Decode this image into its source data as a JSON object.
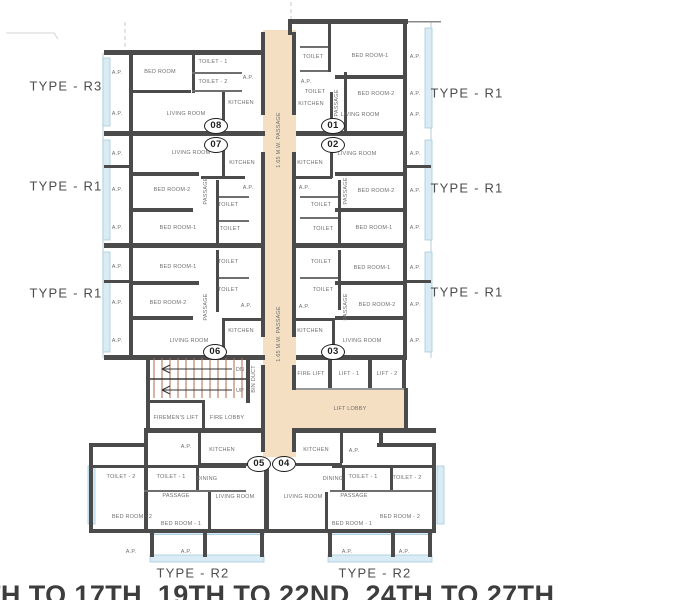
{
  "plan": {
    "caption": "TH TO 17TH, 19TH TO 22ND, 24TH TO 27TH",
    "colors": {
      "wall": "#4b4b4b",
      "corridor": "#f4dfc2",
      "window": "#d9ecf5",
      "stair_tread": "#b06a52"
    },
    "type_labels": [
      {
        "text": "TYPE - R3",
        "x": 66,
        "y": 86
      },
      {
        "text": "TYPE - R1",
        "x": 66,
        "y": 186
      },
      {
        "text": "TYPE - R1",
        "x": 66,
        "y": 293
      },
      {
        "text": "TYPE - R1",
        "x": 467,
        "y": 93
      },
      {
        "text": "TYPE - R1",
        "x": 467,
        "y": 188
      },
      {
        "text": "TYPE - R1",
        "x": 467,
        "y": 292
      },
      {
        "text": "TYPE - R2",
        "x": 193,
        "y": 573
      },
      {
        "text": "TYPE - R2",
        "x": 375,
        "y": 573
      }
    ],
    "unit_circles": [
      {
        "num": "08",
        "x": 216,
        "y": 126
      },
      {
        "num": "07",
        "x": 216,
        "y": 145
      },
      {
        "num": "01",
        "x": 333,
        "y": 126
      },
      {
        "num": "02",
        "x": 333,
        "y": 145
      },
      {
        "num": "06",
        "x": 215,
        "y": 352
      },
      {
        "num": "03",
        "x": 333,
        "y": 352
      },
      {
        "num": "05",
        "x": 259,
        "y": 464
      },
      {
        "num": "04",
        "x": 284,
        "y": 464
      }
    ],
    "room_labels": [
      {
        "text": "A.P.",
        "x": 117,
        "y": 73
      },
      {
        "text": "BED ROOM",
        "x": 160,
        "y": 72
      },
      {
        "text": "TOILET - 1",
        "x": 213,
        "y": 62
      },
      {
        "text": "TOILET - 2",
        "x": 213,
        "y": 82
      },
      {
        "text": "A.P.",
        "x": 248,
        "y": 78
      },
      {
        "text": "KITCHEN",
        "x": 241,
        "y": 103
      },
      {
        "text": "A.P.",
        "x": 117,
        "y": 114
      },
      {
        "text": "LIVING ROOM",
        "x": 186,
        "y": 114
      },
      {
        "text": "TOILET",
        "x": 313,
        "y": 57
      },
      {
        "text": "BED ROOM-1",
        "x": 370,
        "y": 56
      },
      {
        "text": "A.P.",
        "x": 415,
        "y": 57
      },
      {
        "text": "TOILET",
        "x": 315,
        "y": 92
      },
      {
        "text": "PASSAGE",
        "x": 337,
        "y": 103,
        "rot": -90
      },
      {
        "text": "BED ROOM-2",
        "x": 376,
        "y": 94
      },
      {
        "text": "A.P.",
        "x": 415,
        "y": 94
      },
      {
        "text": "A.P.",
        "x": 306,
        "y": 82
      },
      {
        "text": "KITCHEN",
        "x": 311,
        "y": 104
      },
      {
        "text": "LIVING ROOM",
        "x": 360,
        "y": 115
      },
      {
        "text": "A.P.",
        "x": 415,
        "y": 115
      },
      {
        "text": "KITCHEN",
        "x": 310,
        "y": 163
      },
      {
        "text": "LIVING ROOM",
        "x": 357,
        "y": 154
      },
      {
        "text": "A.P.",
        "x": 415,
        "y": 154
      },
      {
        "text": "A.P.",
        "x": 304,
        "y": 188
      },
      {
        "text": "BED ROOM-2",
        "x": 376,
        "y": 191
      },
      {
        "text": "A.P.",
        "x": 415,
        "y": 191
      },
      {
        "text": "PASSAGE",
        "x": 346,
        "y": 191,
        "rot": -90
      },
      {
        "text": "TOILET",
        "x": 321,
        "y": 205
      },
      {
        "text": "TOILET",
        "x": 323,
        "y": 229
      },
      {
        "text": "BED ROOM-1",
        "x": 374,
        "y": 228
      },
      {
        "text": "A.P.",
        "x": 415,
        "y": 228
      },
      {
        "text": "TOILET",
        "x": 321,
        "y": 262
      },
      {
        "text": "BED ROOM-1",
        "x": 372,
        "y": 268
      },
      {
        "text": "A.P.",
        "x": 415,
        "y": 268
      },
      {
        "text": "TOILET",
        "x": 323,
        "y": 290
      },
      {
        "text": "BED ROOM-2",
        "x": 377,
        "y": 305
      },
      {
        "text": "A.P.",
        "x": 415,
        "y": 305
      },
      {
        "text": "PASSAGE",
        "x": 346,
        "y": 307,
        "rot": -90
      },
      {
        "text": "A.P.",
        "x": 304,
        "y": 307
      },
      {
        "text": "KITCHEN",
        "x": 310,
        "y": 331
      },
      {
        "text": "LIVING ROOM",
        "x": 362,
        "y": 341
      },
      {
        "text": "A.P.",
        "x": 415,
        "y": 341
      },
      {
        "text": "A.P.",
        "x": 117,
        "y": 154
      },
      {
        "text": "LIVING ROOM",
        "x": 191,
        "y": 153
      },
      {
        "text": "KITCHEN",
        "x": 242,
        "y": 163
      },
      {
        "text": "A.P.",
        "x": 117,
        "y": 190
      },
      {
        "text": "BED ROOM-2",
        "x": 172,
        "y": 190
      },
      {
        "text": "PASSAGE",
        "x": 206,
        "y": 191,
        "rot": -90
      },
      {
        "text": "A.P.",
        "x": 248,
        "y": 188
      },
      {
        "text": "TOILET",
        "x": 228,
        "y": 205
      },
      {
        "text": "TOILET",
        "x": 230,
        "y": 229
      },
      {
        "text": "A.P.",
        "x": 117,
        "y": 228
      },
      {
        "text": "BED ROOM-1",
        "x": 178,
        "y": 228
      },
      {
        "text": "A.P.",
        "x": 117,
        "y": 267
      },
      {
        "text": "BED ROOM-1",
        "x": 178,
        "y": 267
      },
      {
        "text": "TOILET",
        "x": 228,
        "y": 262
      },
      {
        "text": "A.P.",
        "x": 117,
        "y": 303
      },
      {
        "text": "BED ROOM-2",
        "x": 168,
        "y": 303
      },
      {
        "text": "TOILET",
        "x": 228,
        "y": 290
      },
      {
        "text": "PASSAGE",
        "x": 206,
        "y": 307,
        "rot": -90
      },
      {
        "text": "A.P.",
        "x": 246,
        "y": 306
      },
      {
        "text": "KITCHEN",
        "x": 241,
        "y": 331
      },
      {
        "text": "A.P.",
        "x": 117,
        "y": 341
      },
      {
        "text": "LIVING ROOM",
        "x": 189,
        "y": 341
      },
      {
        "text": "DN",
        "x": 240,
        "y": 370
      },
      {
        "text": "UP",
        "x": 240,
        "y": 391
      },
      {
        "text": "BIN DUCT",
        "x": 254,
        "y": 379,
        "rot": -90
      },
      {
        "text": "FIREMEN'S LIFT",
        "x": 176,
        "y": 418
      },
      {
        "text": "FIRE LOBBY",
        "x": 227,
        "y": 418
      },
      {
        "text": "FIRE LIFT",
        "x": 311,
        "y": 374
      },
      {
        "text": "LIFT - 1",
        "x": 349,
        "y": 374
      },
      {
        "text": "LIFT - 2",
        "x": 387,
        "y": 374
      },
      {
        "text": "LIFT LOBBY",
        "x": 350,
        "y": 409
      },
      {
        "text": "1.65 M.W. PASSAGE",
        "x": 279,
        "y": 140,
        "rot": -90
      },
      {
        "text": "1.65 M.W. PASSAGE",
        "x": 279,
        "y": 334,
        "rot": -90
      },
      {
        "text": "A.P.",
        "x": 186,
        "y": 447
      },
      {
        "text": "KITCHEN",
        "x": 222,
        "y": 450
      },
      {
        "text": "TOILET - 2",
        "x": 121,
        "y": 477
      },
      {
        "text": "TOILET - 1",
        "x": 171,
        "y": 477
      },
      {
        "text": "DINING",
        "x": 207,
        "y": 479
      },
      {
        "text": "PASSAGE",
        "x": 176,
        "y": 496
      },
      {
        "text": "LIVING ROOM",
        "x": 235,
        "y": 497
      },
      {
        "text": "BED ROOM - 2",
        "x": 132,
        "y": 517
      },
      {
        "text": "BED ROOM - 1",
        "x": 181,
        "y": 524
      },
      {
        "text": "A.P.",
        "x": 131,
        "y": 552
      },
      {
        "text": "A.P.",
        "x": 186,
        "y": 552
      },
      {
        "text": "KITCHEN",
        "x": 316,
        "y": 450
      },
      {
        "text": "A.P.",
        "x": 354,
        "y": 451
      },
      {
        "text": "DINING",
        "x": 333,
        "y": 479
      },
      {
        "text": "LIVING ROOM",
        "x": 303,
        "y": 497
      },
      {
        "text": "TOILET - 1",
        "x": 363,
        "y": 477
      },
      {
        "text": "TOILET - 2",
        "x": 407,
        "y": 478
      },
      {
        "text": "PASSAGE",
        "x": 354,
        "y": 496
      },
      {
        "text": "BED ROOM - 1",
        "x": 352,
        "y": 524
      },
      {
        "text": "BED ROOM - 2",
        "x": 400,
        "y": 517
      },
      {
        "text": "A.P.",
        "x": 347,
        "y": 552
      },
      {
        "text": "A.P.",
        "x": 404,
        "y": 552
      }
    ]
  }
}
